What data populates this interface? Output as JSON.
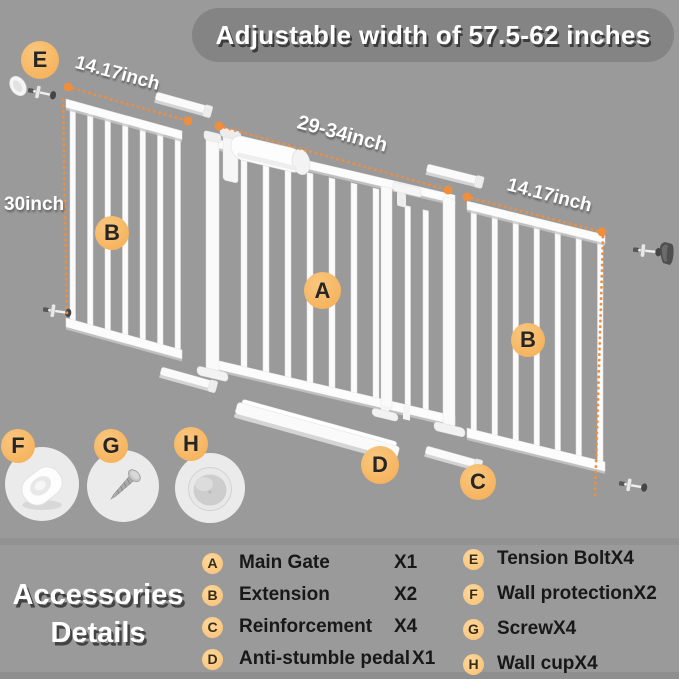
{
  "banner": {
    "text": "Adjustable width of 57.5-62 inches"
  },
  "measurements": {
    "left_width": "14.17inch",
    "center_width": "29-34inch",
    "right_width": "14.17inch",
    "height": "30inch"
  },
  "part_labels": {
    "a": "A",
    "b_left": "B",
    "b_right": "B",
    "c": "C",
    "d": "D",
    "e": "E",
    "f": "F",
    "g": "G",
    "h": "H"
  },
  "accessories": {
    "title_line1": "Accessories",
    "title_line2": "Details",
    "columns": {
      "left": [
        {
          "letter": "A",
          "name": "Main Gate",
          "qty": "X1"
        },
        {
          "letter": "B",
          "name": "Extension",
          "qty": "X2"
        },
        {
          "letter": "C",
          "name": "Reinforcement",
          "qty": "X4"
        },
        {
          "letter": "D",
          "name": "Anti-stumble pedal",
          "qty": "X1"
        }
      ],
      "right": [
        {
          "letter": "E",
          "name": "Tension Bolt",
          "qty": "X4"
        },
        {
          "letter": "F",
          "name": "Wall protection",
          "qty": "X2"
        },
        {
          "letter": "G",
          "name": "Screw",
          "qty": "X4"
        },
        {
          "letter": "H",
          "name": "Wall cup",
          "qty": "X4"
        }
      ]
    }
  },
  "illustrations": {
    "main_gate": "white-pressure-gate-with-handle",
    "extensions": "white-bar-gate-panels",
    "reinforcement": "short-white-bar",
    "anti_stumble_pedal": "long-white-ramp-bar",
    "tension_bolt": "bolt-with-washer",
    "wall_protection": "oval-wall-pad",
    "screw": "metal-screw",
    "wall_cup": "round-wall-cup"
  },
  "colors": {
    "background": "#9a9a9a",
    "banner_background": "#848484",
    "accent_orange": "#ef8f3e",
    "label_circle_orange": "#f7bb69",
    "list_badge_orange": "#f9c87d",
    "gate_white": "#fcfcfc",
    "text_white": "#ffffff",
    "text_dark": "#1b1b1b"
  }
}
